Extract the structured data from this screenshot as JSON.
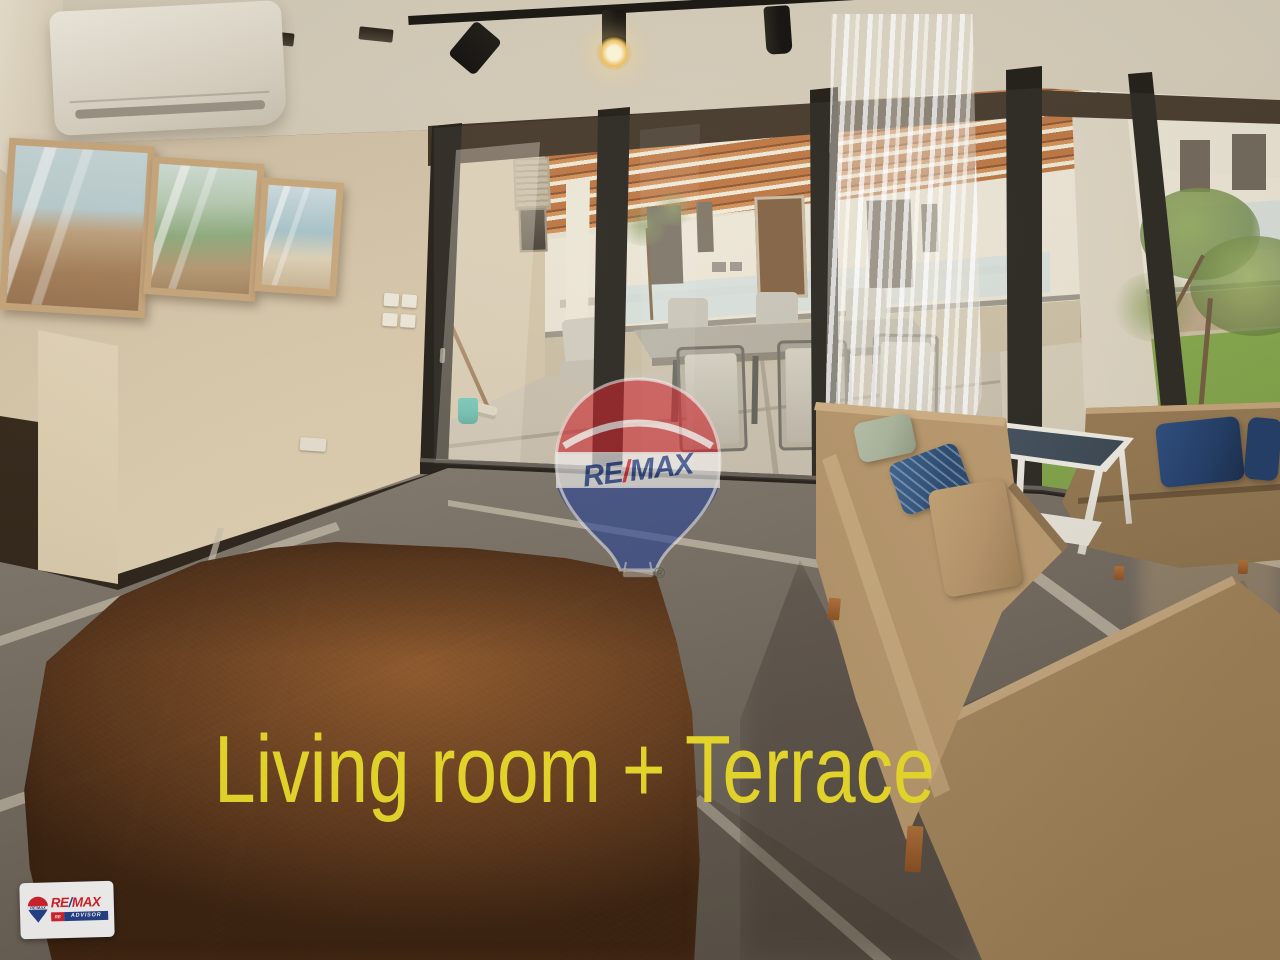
{
  "image": {
    "type": "real-estate-photo",
    "caption": "Living room + Terrace",
    "scene": "Living room with wall art and AC unit, sliding glass doors to covered pergola terrace with outdoor dining set, tan sectional sofas, shaggy brown rug, lawn and buildings outside"
  },
  "watermark": {
    "re": "RE",
    "slash": "/",
    "max": "MAX",
    "registered": "®"
  },
  "corner_logo": {
    "re": "RE",
    "slash": "/",
    "max": "MAX",
    "sub_left": "RE",
    "sub_right": "ADVISOR"
  },
  "colors": {
    "caption_yellow": "#f0e128",
    "remax_red": "#dd2029",
    "remax_blue": "#23418f",
    "ceiling": "#cdc3ae",
    "wall": "#d9c9b0",
    "wall_bright": "#efe2c6",
    "header_dark": "#2c2217",
    "frame_black": "#1e1a14",
    "pergola_wood": "#bd7038",
    "pergola_gap": "#f3ecd9",
    "building_cream": "#efe8d6",
    "stone_wall": "#c5b89e",
    "lawn_green": "#7ca23f",
    "terrace_floor": "#c9beab",
    "curtain_white": "#f7f3ea",
    "floor_gray": "#837a6e",
    "grout": "#cdc3b1",
    "rug_dark": "#42280f",
    "rug_light": "#8a5526",
    "sofa_tan": "#a98a60",
    "sofa_light": "#c3a377",
    "pillow_navy": "#1d3a66",
    "pillow_sage": "#a9b49b",
    "pillow_tan": "#b8956a",
    "wood_leg": "#a86330",
    "table_white": "#efece4",
    "table_glass": "#4f5d6a",
    "ac_white": "#eee8da",
    "bucket_teal": "#3db3a4"
  }
}
